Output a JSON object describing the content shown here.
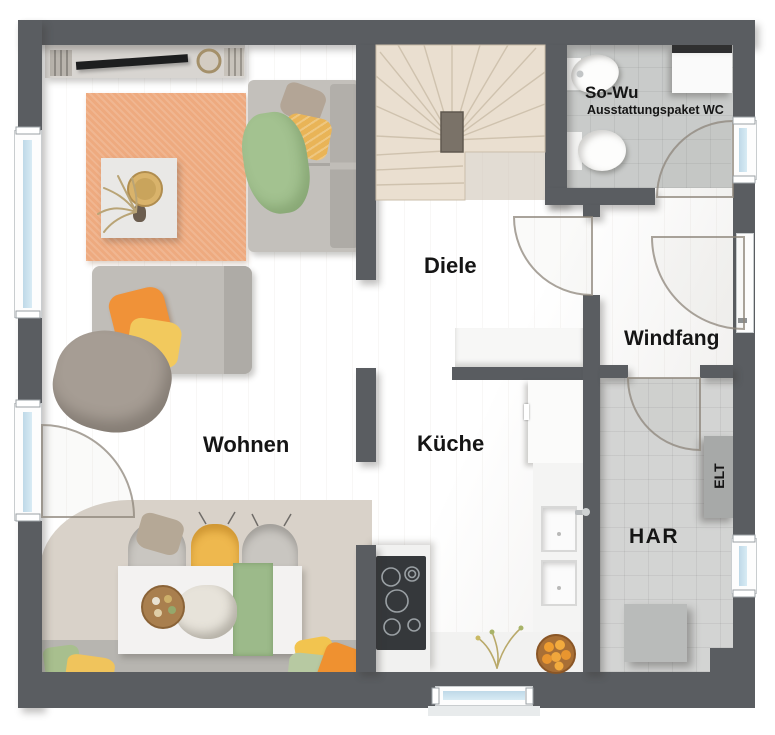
{
  "floorplan": {
    "labels": {
      "wohnen": "Wohnen",
      "diele": "Diele",
      "kueche": "Küche",
      "windfang": "Windfang",
      "har": "HAR",
      "so_wu": "So-Wu",
      "so_wu_sub": "Ausstattungspaket WC",
      "elt": "ELT"
    },
    "colors": {
      "wall": "#5a5d61",
      "wood_floor": "#ddd2c2",
      "stair_wood": "#eae0d2",
      "tile_wc": "#c9cbca",
      "tile_har": "#d3d4d3",
      "rug_living": "#eeaa7f",
      "sofa_gray": "#c3c0bb",
      "blanket_green": "#a3c290",
      "pillow_orange": "#f09238",
      "pillow_yellow": "#f2c45c",
      "chair_mustard": "#eeb84e",
      "window_glass": "#cde2ef",
      "counter_white": "#f4f4f3",
      "cooktop_dark": "#35383b",
      "elt_panel": "#a7a9a8",
      "label_text": "#151515"
    }
  }
}
